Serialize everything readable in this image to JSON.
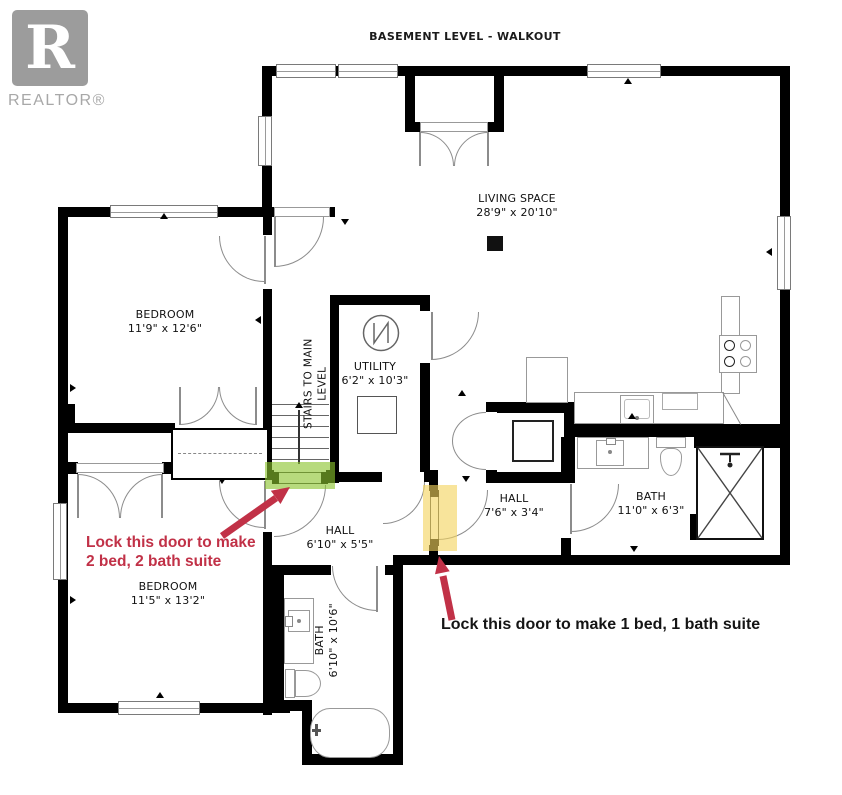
{
  "header": {
    "title": "BASEMENT LEVEL - WALKOUT",
    "logo": {
      "letter": "R",
      "label": "REALTOR®"
    }
  },
  "rooms": {
    "living": {
      "name": "LIVING SPACE",
      "dims": "28'9\" x 20'10\""
    },
    "bedroom_upper": {
      "name": "BEDROOM",
      "dims": "11'9\" x 12'6\""
    },
    "bedroom_lower": {
      "name": "BEDROOM",
      "dims": "11'5\" x 13'2\""
    },
    "utility": {
      "name": "UTILITY",
      "dims": "6'2\" x 10'3\""
    },
    "hall_lower": {
      "name": "HALL",
      "dims": "6'10\" x 5'5\""
    },
    "hall_right": {
      "name": "HALL",
      "dims": "7'6\" x 3'4\""
    },
    "bath_right": {
      "name": "BATH",
      "dims": "11'0\" x 6'3\""
    },
    "bath_lower": {
      "name": "BATH",
      "dims": "6'10\" x 10'6\""
    },
    "stairs": {
      "name": "STAIRS TO MAIN LEVEL"
    }
  },
  "annotations": {
    "suite2": {
      "line1": "Lock this door to make",
      "line2": "2 bed, 2 bath suite"
    },
    "suite1": {
      "text": "Lock this door to make 1 bed, 1 bath suite"
    }
  },
  "colors": {
    "wall": "#000000",
    "annotation_red": "#c13147",
    "highlight_green": "#9bcb3b",
    "highlight_yellow": "#f5d66b",
    "logo_gray": "#9c9c9c"
  }
}
